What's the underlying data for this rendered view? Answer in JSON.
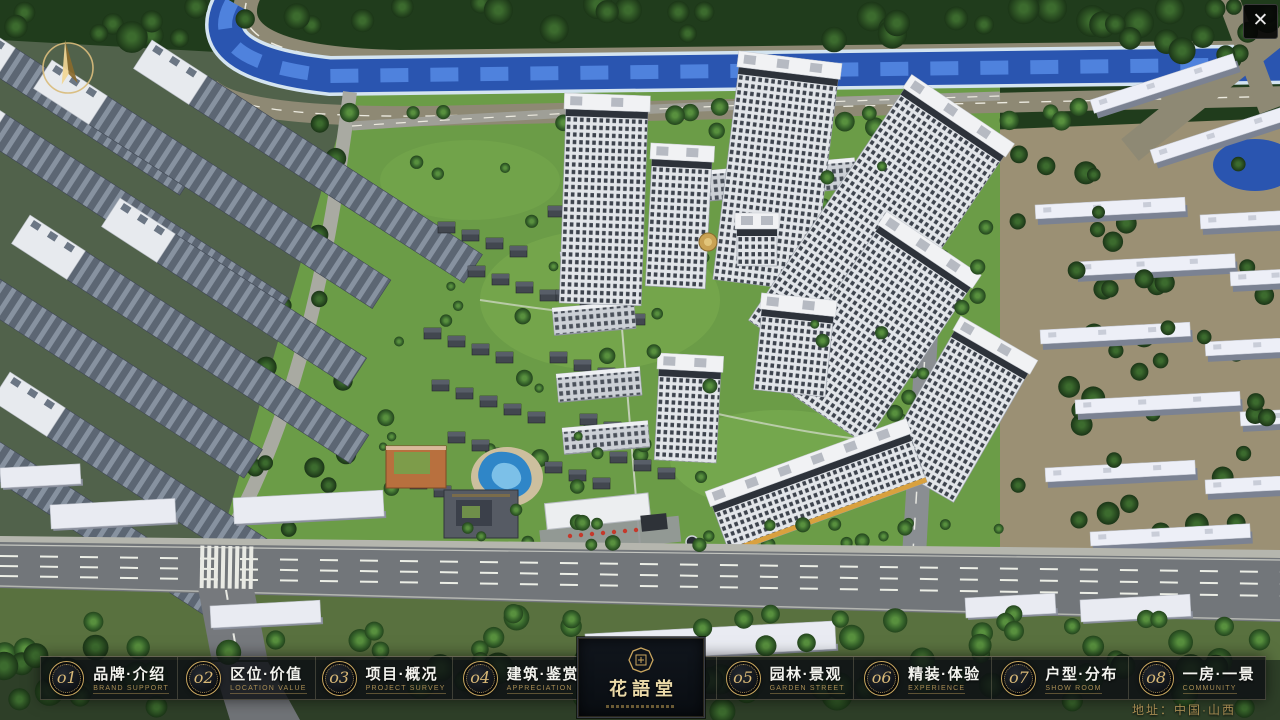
{
  "window": {
    "close_label": "✕"
  },
  "menu": {
    "items": [
      {
        "num": "o1",
        "zh": "品牌·介绍",
        "en": "BRAND SUPPORT"
      },
      {
        "num": "o2",
        "zh": "区位·价值",
        "en": "LOCATION VALUE"
      },
      {
        "num": "o3",
        "zh": "项目·概况",
        "en": "PROJECT SURVEY"
      },
      {
        "num": "o4",
        "zh": "建筑·鉴赏",
        "en": "APPRECIATION"
      },
      {
        "num": "o5",
        "zh": "园林·景观",
        "en": "GARDEN STREET"
      },
      {
        "num": "o6",
        "zh": "精装·体验",
        "en": "EXPERIENCE"
      },
      {
        "num": "o7",
        "zh": "户型·分布",
        "en": "SHOW ROOM"
      },
      {
        "num": "o8",
        "zh": "一房·一景",
        "en": "COMMUNITY"
      }
    ]
  },
  "logo": {
    "title": "花語堂"
  },
  "footer": {
    "address": "地址：中国·山西"
  },
  "colors": {
    "gold": "#c9a75f",
    "gold_dim": "#a98d54",
    "bar_bg": "rgba(12,15,19,0.80)",
    "text_white": "#f3f3ee",
    "river_blue": "#2a55b0",
    "lawn_green": "#6b9c47"
  }
}
